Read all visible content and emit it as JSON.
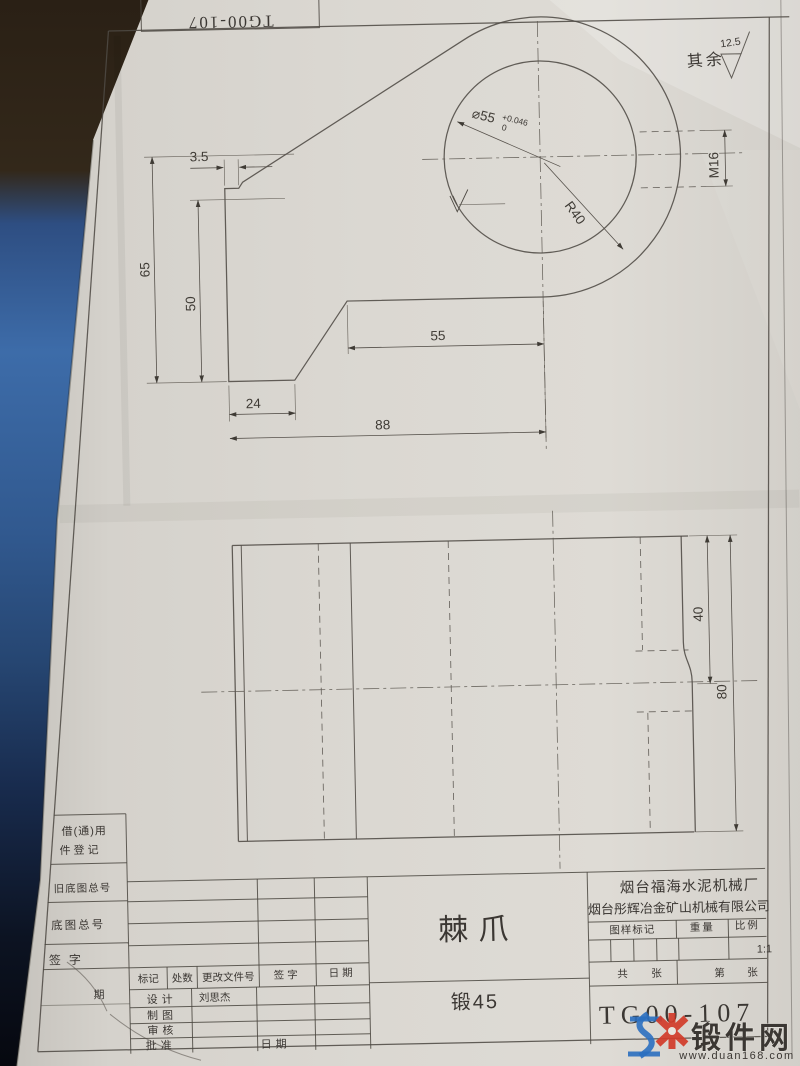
{
  "watermark": {
    "brand": "锻件网",
    "url": "www.duan168.com"
  },
  "drawing": {
    "corner_number": "TG00-107",
    "general_roughness": {
      "label": "其余",
      "value": "12.5"
    },
    "dims": {
      "bore": "⌀55",
      "bore_tol_up": "+0.046",
      "bore_tol_dn": "0",
      "radius": "R40",
      "thread": "M16",
      "step": "3.5",
      "h_total": "65",
      "h_inner": "50",
      "w_foot": "24",
      "w_total": "88",
      "w_upper": "55",
      "side_half": "40",
      "side_full": "80"
    },
    "title": {
      "part_name": "棘爪",
      "material": "锻45",
      "drawing_no": "TG00-107",
      "company_1": "烟台福海水泥机械厂",
      "company_2": "烟台彤辉冶金矿山机械有限公司",
      "scale_value": "1:1",
      "col_mark": "图样标记",
      "col_weight": "重量",
      "col_scale": "比例",
      "sheets_total": "共",
      "sheets_unit": "张",
      "sheet_no": "第",
      "sheet_unit2": "张",
      "rev_mark": "标记",
      "rev_count": "处数",
      "rev_doc": "更改文件号",
      "rev_sign": "签字",
      "rev_date": "日期",
      "row_design": "设计",
      "row_draw": "制图",
      "row_check": "审核",
      "row_approve": "批准",
      "designer_name": "刘思杰",
      "approve_date_label": "日期",
      "left_reuse_1": "借(通)用",
      "left_reuse_2": "件登记",
      "left_old_no": "旧底图总号",
      "left_base_no": "底图总号",
      "left_sign": "签字",
      "left_date_ghost": "期"
    }
  }
}
